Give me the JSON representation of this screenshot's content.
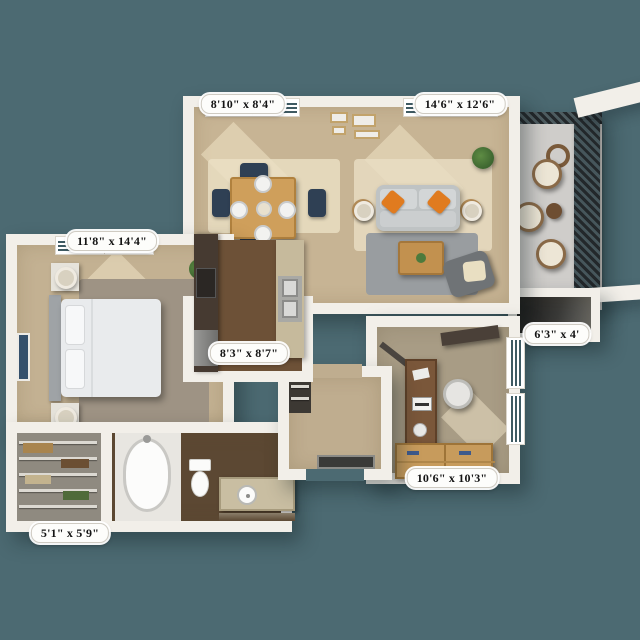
{
  "floorplan": {
    "type": "apartment-3d-floorplan",
    "rooms": {
      "dining": {
        "name": "dining area",
        "dimensions": "8'10\" x 8'4\""
      },
      "living": {
        "name": "living room",
        "dimensions": "14'6\" x 12'6\""
      },
      "bedroom": {
        "name": "bedroom",
        "dimensions": "11'8\" x 14'4\""
      },
      "kitchen": {
        "name": "kitchen",
        "dimensions": "8'3\" x 8'7\""
      },
      "balcony_storage": {
        "name": "balcony storage",
        "dimensions": "6'3\" x 4'"
      },
      "den": {
        "name": "den / office",
        "dimensions": "10'6\" x 10'3\""
      },
      "closet": {
        "name": "walk-in closet",
        "dimensions": "5'1\" x 5'9\""
      }
    },
    "colors": {
      "background": "#4C6A72",
      "wall": "#F2EFE9",
      "carpet_living": "#C7B494",
      "carpet_bedroom": "#C3B192",
      "kitchen_wood": "#6D5137",
      "bath_wood": "#5C4833",
      "den_floor": "#A89C85",
      "balcony_floor": "#CFCDCA",
      "sofa_gray": "#BFC3C4",
      "accent_pillow_orange": "#E07B1F",
      "dining_chair_navy": "#2F4054",
      "wood_table": "#CF9F5B",
      "cardboard_box": "#C79B5C",
      "railing_dark": "#2E3135",
      "window_glass": "#3E5A62"
    }
  }
}
